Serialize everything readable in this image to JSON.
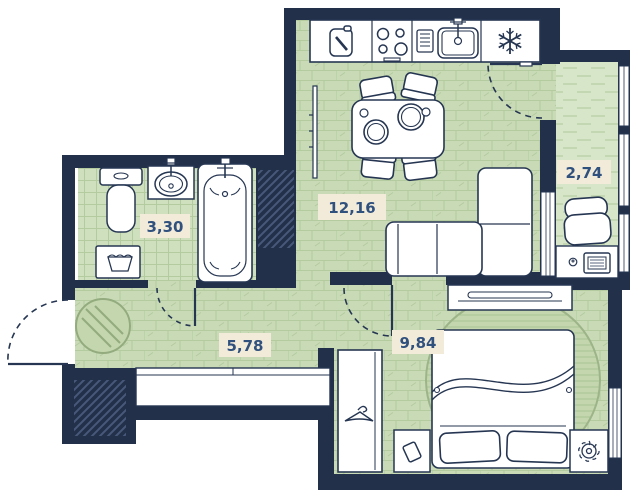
{
  "title": "apartment-floor-plan",
  "rooms": [
    {
      "name": "kitchen-living-room",
      "area": "12,16"
    },
    {
      "name": "balcony",
      "area": "2,74"
    },
    {
      "name": "bathroom",
      "area": "3,30"
    },
    {
      "name": "hallway",
      "area": "5,78"
    },
    {
      "name": "bedroom",
      "area": "9,84"
    }
  ],
  "colors": {
    "wall": "#223049",
    "outline": "#263652",
    "floor_brick": "#c9dbb6",
    "floor_balcony": "#d7e5c9",
    "floor_tile": "#cfe0bf",
    "floor_line": "#b4ca9f",
    "rug": "#c3d6ad",
    "label_bg": "#f3ebda",
    "label_text": "#30507d",
    "hatch": "#47587a"
  },
  "icons": [
    "cutting-board-icon",
    "stove-icon",
    "dish-rack-icon",
    "sink-icon",
    "snowflake-icon",
    "hanger-icon",
    "laptop-icon",
    "mouse-icon",
    "book-icon",
    "plant-icon",
    "laundry-basket-icon",
    "faucet-icon"
  ]
}
